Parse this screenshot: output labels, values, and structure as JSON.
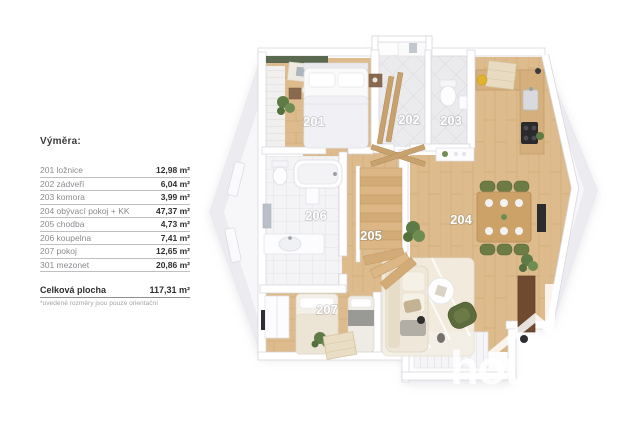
{
  "legend": {
    "title": "Výměra:",
    "rows": [
      {
        "name": "201 ložnice",
        "area": "12,98 m²"
      },
      {
        "name": "202 zádveří",
        "area": "6,04 m²"
      },
      {
        "name": "203 komora",
        "area": "3,99 m²"
      },
      {
        "name": "204 obývací pokoj + KK",
        "area": "47,37 m²"
      },
      {
        "name": "205 chodba",
        "area": "4,73 m²"
      },
      {
        "name": "206 koupelna",
        "area": "7,41 m²"
      },
      {
        "name": "207 pokoj",
        "area": "12,65 m²"
      },
      {
        "name": "301 mezonet",
        "area": "20,86 m²"
      }
    ],
    "total_label": "Celková plocha",
    "total_area": "117,31 m²",
    "footnote": "*uvedené rozměry jsou pouze orientační"
  },
  "plan": {
    "labels": {
      "r201": "201",
      "r202": "202",
      "r203": "203",
      "r204": "204",
      "r205": "205",
      "r206": "206",
      "r207": "207"
    }
  },
  "watermark": {
    "text": "hous"
  },
  "colors": {
    "wood_floor": "#ddbb8c",
    "tile_floor": "#ebebee",
    "bath_tile": "#f4f4f6",
    "accent_wall_green": "#5a6950",
    "plant_green": "#5f7b45",
    "chair_olive": "#6d7b45",
    "cabinet_brown": "#6f4a31",
    "room_label": "#ffffff",
    "legend_text": "#8b8b8f",
    "legend_value": "#2f2f31",
    "watermark_white": "rgba(255,255,255,0.85)"
  }
}
